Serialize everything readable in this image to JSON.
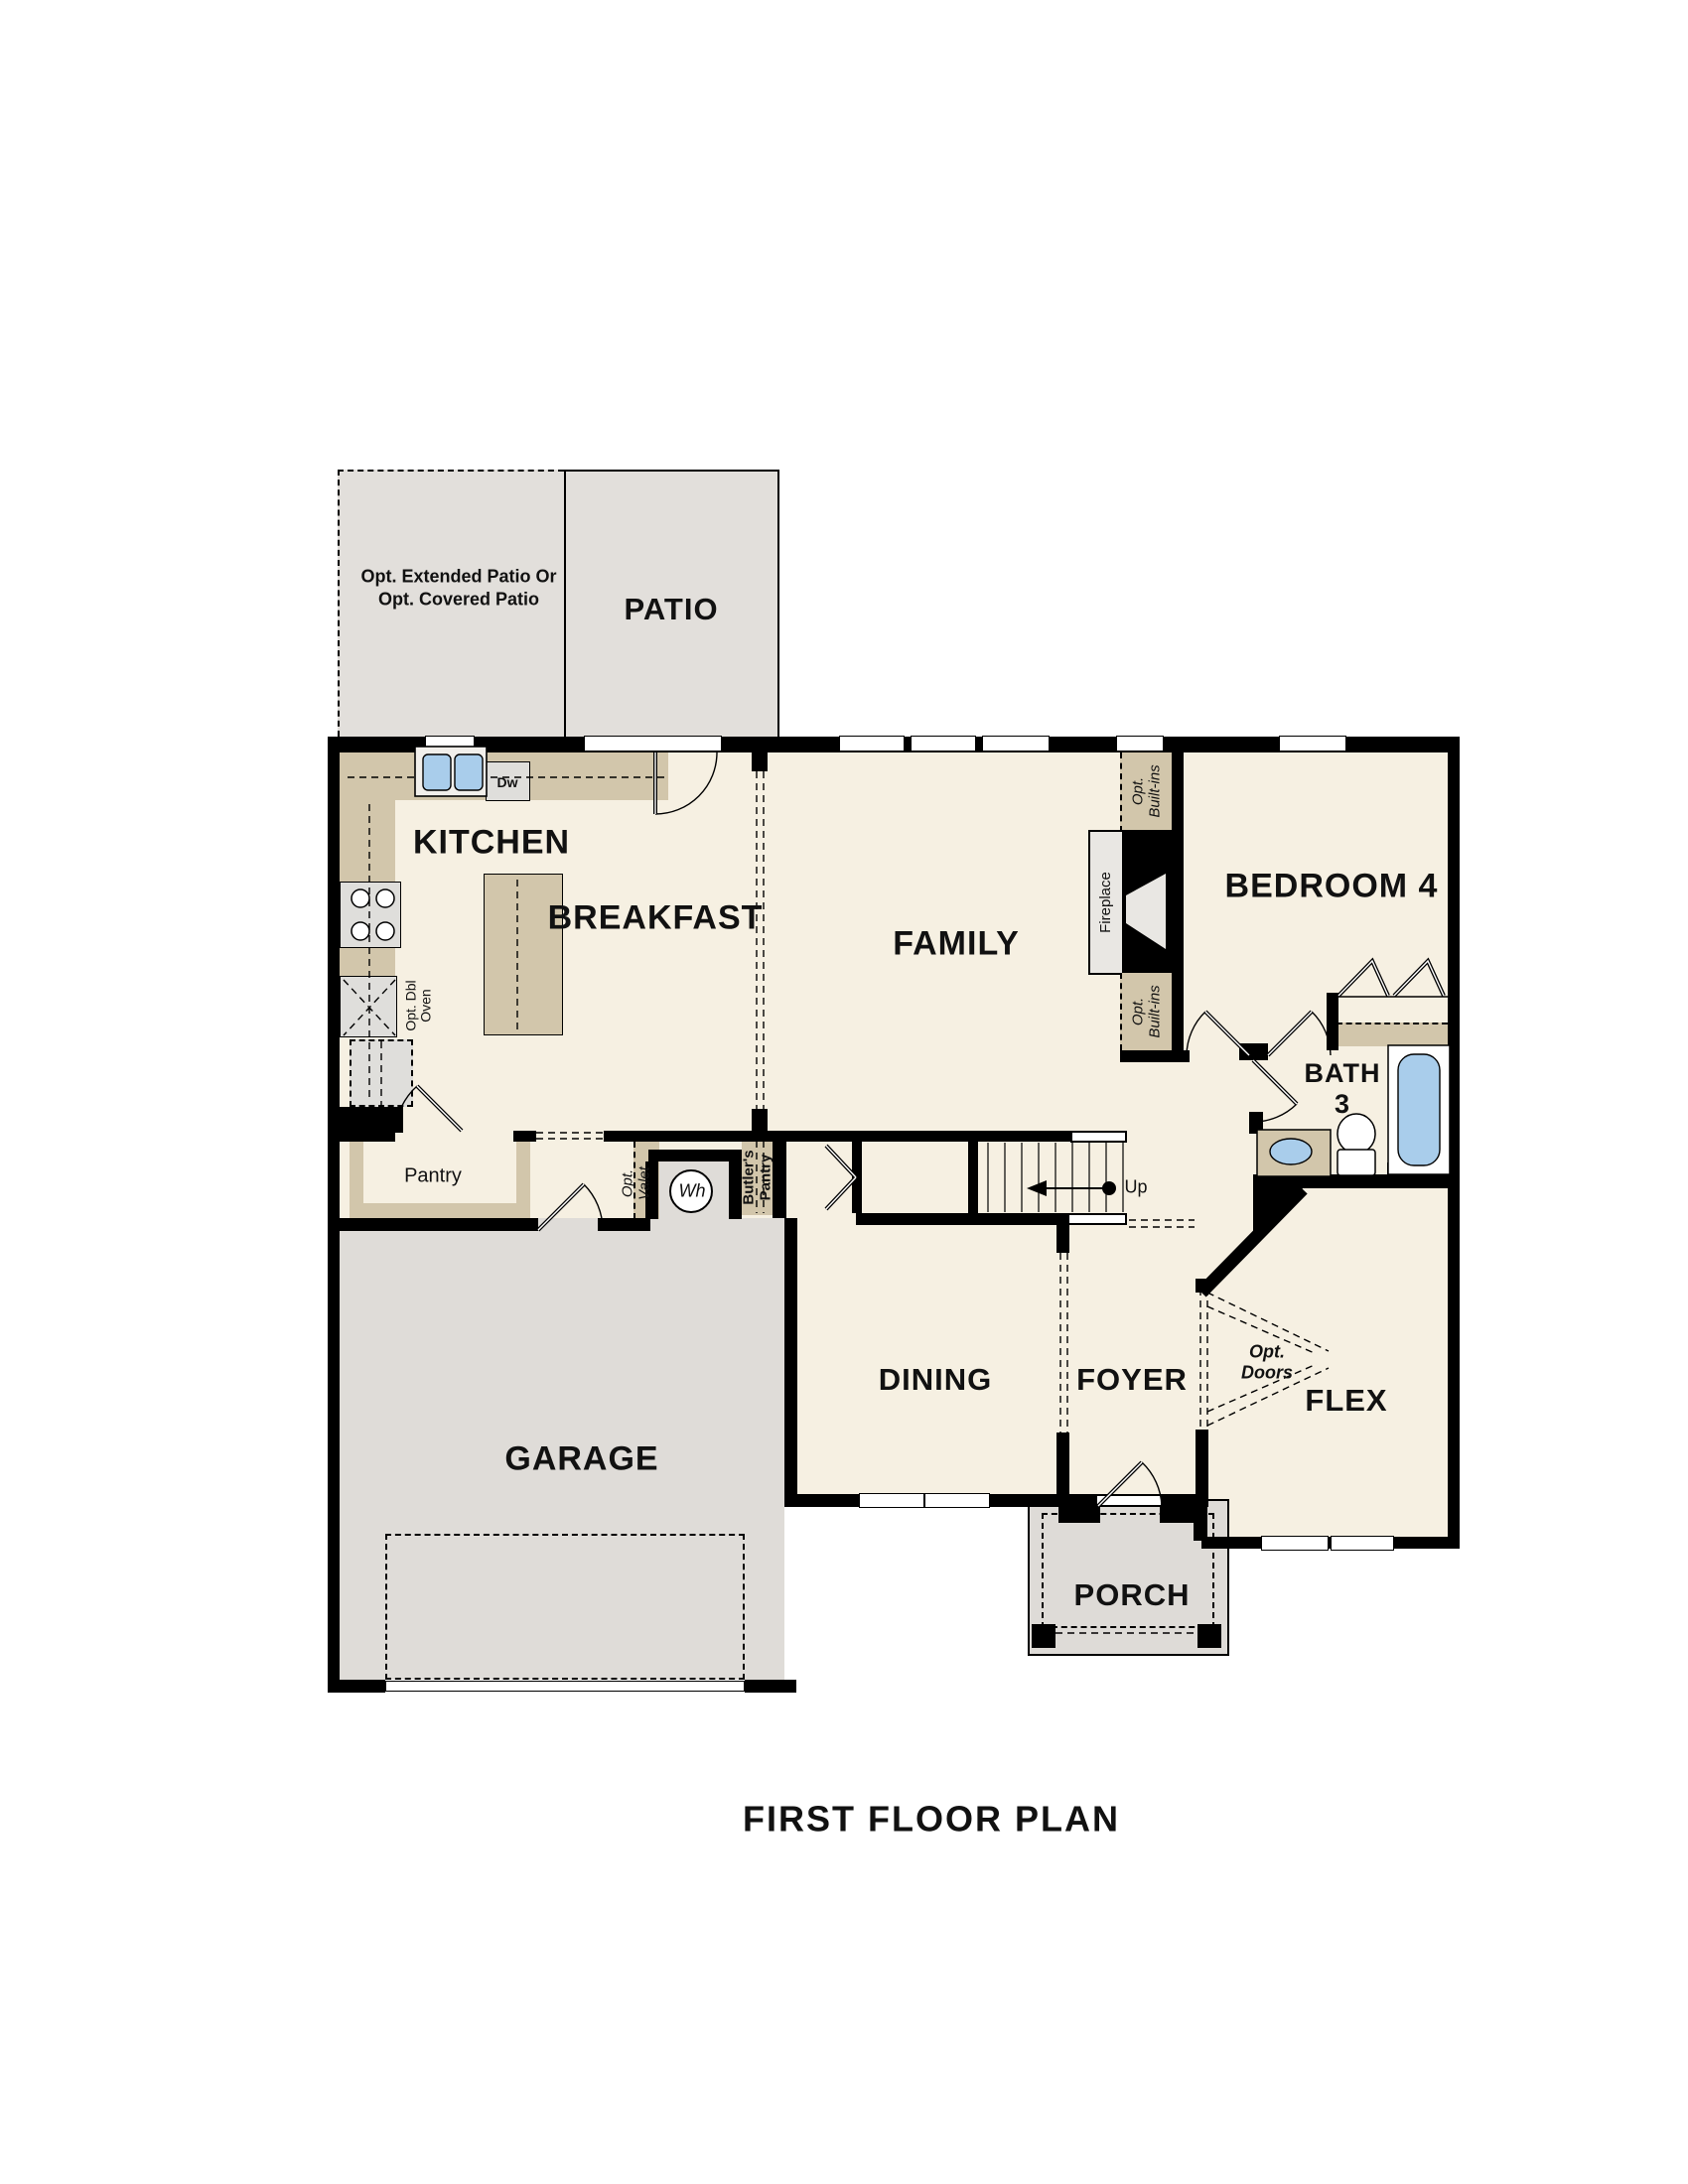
{
  "title": "FIRST FLOOR PLAN",
  "rooms": {
    "opt_patio": "Opt. Extended Patio Or\nOpt. Covered Patio",
    "patio": "PATIO",
    "kitchen": "KITCHEN",
    "breakfast": "BREAKFAST",
    "family": "FAMILY",
    "bedroom4": "BEDROOM 4",
    "bath3": "BATH\n3",
    "garage": "GARAGE",
    "dining": "DINING",
    "foyer": "FOYER",
    "flex": "FLEX",
    "porch": "PORCH"
  },
  "labels": {
    "pantry": "Pantry",
    "butlers_pantry": "Butler's\nPantry",
    "opt_valet": "Opt.\nValet",
    "wh": "Wh",
    "dw": "Dw",
    "opt_dbl_oven": "Opt. Dbl\nOven",
    "fireplace": "Fireplace",
    "opt_builtins": "Opt.\nBuilt-ins",
    "up": "Up",
    "opt_doors": "Opt.\nDoors"
  },
  "colors": {
    "wall": "#000000",
    "floor_cream": "#f6f0e2",
    "patio_gray": "#e2dfdb",
    "garage_gray": "#dfdcd8",
    "porch_gray": "#dedbd7",
    "counter_tan": "#d2c6ab",
    "appliance_gray": "#dfdedb",
    "fixture_blue": "#a9cdeb"
  }
}
